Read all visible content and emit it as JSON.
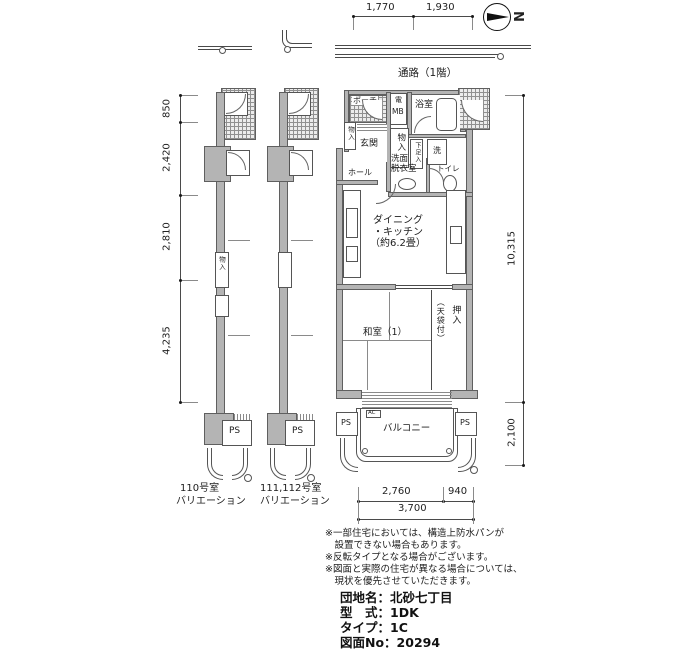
{
  "compass": {
    "north_label": "N"
  },
  "walkway": {
    "label": "通路（1階）"
  },
  "dimensions": {
    "top": [
      "1,770",
      "1,930"
    ],
    "left": [
      "850",
      "2,420",
      "2,810",
      "4,235"
    ],
    "right": [
      "10,315",
      "2,100"
    ],
    "bottom": [
      "2,760",
      "940",
      "3,700"
    ]
  },
  "rooms": {
    "porch": "ポーチ",
    "meter_box_small": "電",
    "meter_box": "MB",
    "bath": "浴室",
    "entrance": "玄関",
    "closet_small": "物入",
    "closet": "物入",
    "shoe_cabinet": "下足入",
    "hall": "ホール",
    "washroom": "洗面\n脱衣室",
    "washer": "洗",
    "toilet": "トイレ",
    "dining_kitchen": "ダイニング\n・キッチン\n（約6.2畳）",
    "japanese_room": "和室（1）",
    "oshiire": "押入",
    "oshiire_note": "（天袋付）",
    "balcony": "バルコニー",
    "ps_left": "PS",
    "ps_right": "PS",
    "ac": "AC"
  },
  "variations": [
    {
      "room_no": "110号室",
      "caption": "バリエーション",
      "ps": "PS",
      "closet": "物入"
    },
    {
      "room_no": "111,112号室",
      "caption": "バリエーション",
      "ps": "PS"
    }
  ],
  "notes": [
    "※一部住宅においては、構造上防水パンが",
    "　設置できない場合もあります。",
    "※反転タイプとなる場合がございます。",
    "※図面と実際の住宅が異なる場合については、",
    "　現状を優先させていただきます。"
  ],
  "info": [
    "団地名：北砂七丁目",
    "型　式：1DK",
    "タイプ：1C",
    "図面No：20294"
  ]
}
